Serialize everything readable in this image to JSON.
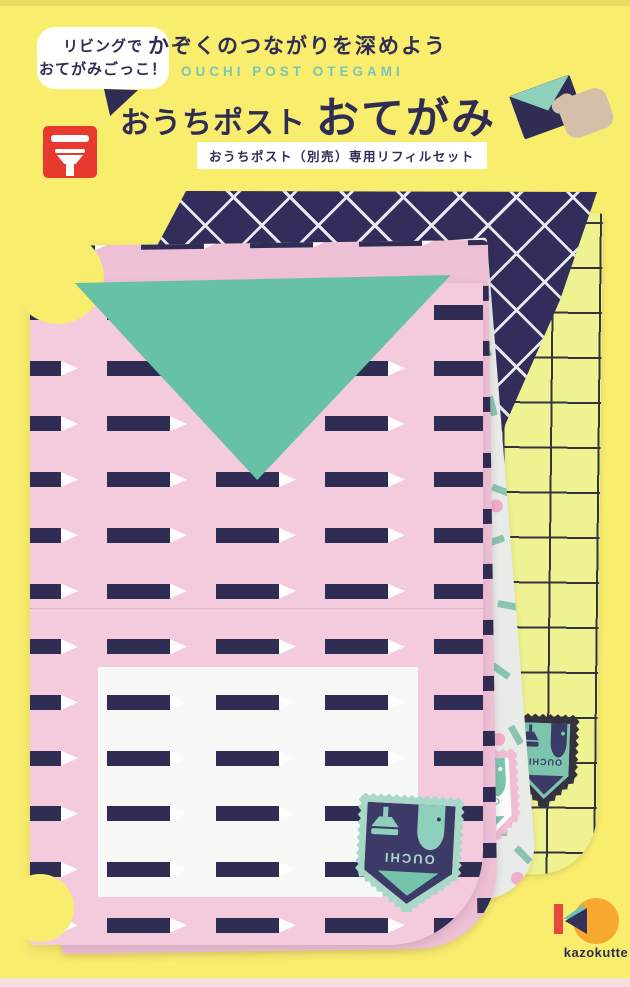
{
  "header": {
    "bubble_line1": "リビングで",
    "bubble_line2": "おてがみごっこ！",
    "tagline": "かぞくのつながりを深めよう",
    "subtitle_en": "OUCHI POST OTEGAMI",
    "title_main_1": "おうちポスト",
    "title_main_2": "おてがみ",
    "ribbon_label": "おうちポスト（別売）専用リフィルセット"
  },
  "stamps": {
    "label": "OUCHI"
  },
  "brand": {
    "logo_text": "kazokutte"
  },
  "colors": {
    "background": "#f8ed6d",
    "navy": "#302d55",
    "teal_flap": "#66c1a7",
    "teal_text": "#7cc5b5",
    "pink_paper": "#f4cadd",
    "pink_paper_back": "#eec0d5",
    "red_post": "#e8392e",
    "grid_paper": "#eff291",
    "grid_line": "#33323e",
    "lattice_navy": "#322d5a",
    "lattice_line": "#e9e9f1",
    "confetti_bg": "#e9ebe8",
    "confetti_dash": "#8ac4ae",
    "confetti_dot": "#f2abc8",
    "hand_beige": "#d4bfa9",
    "logo_orange": "#f7a82e",
    "logo_red": "#e9483f",
    "stamp_mint_border": "#a9d8c8",
    "stamp_navy_house": "#3c3a67",
    "stamp_mint_detail": "#8fd0bd",
    "stamp_teal": "#7cc4ad",
    "stamp_pink_border": "#f0bdd2",
    "stamp_white_house": "#fbfcfb",
    "stamp_dark_border": "#35323f"
  }
}
